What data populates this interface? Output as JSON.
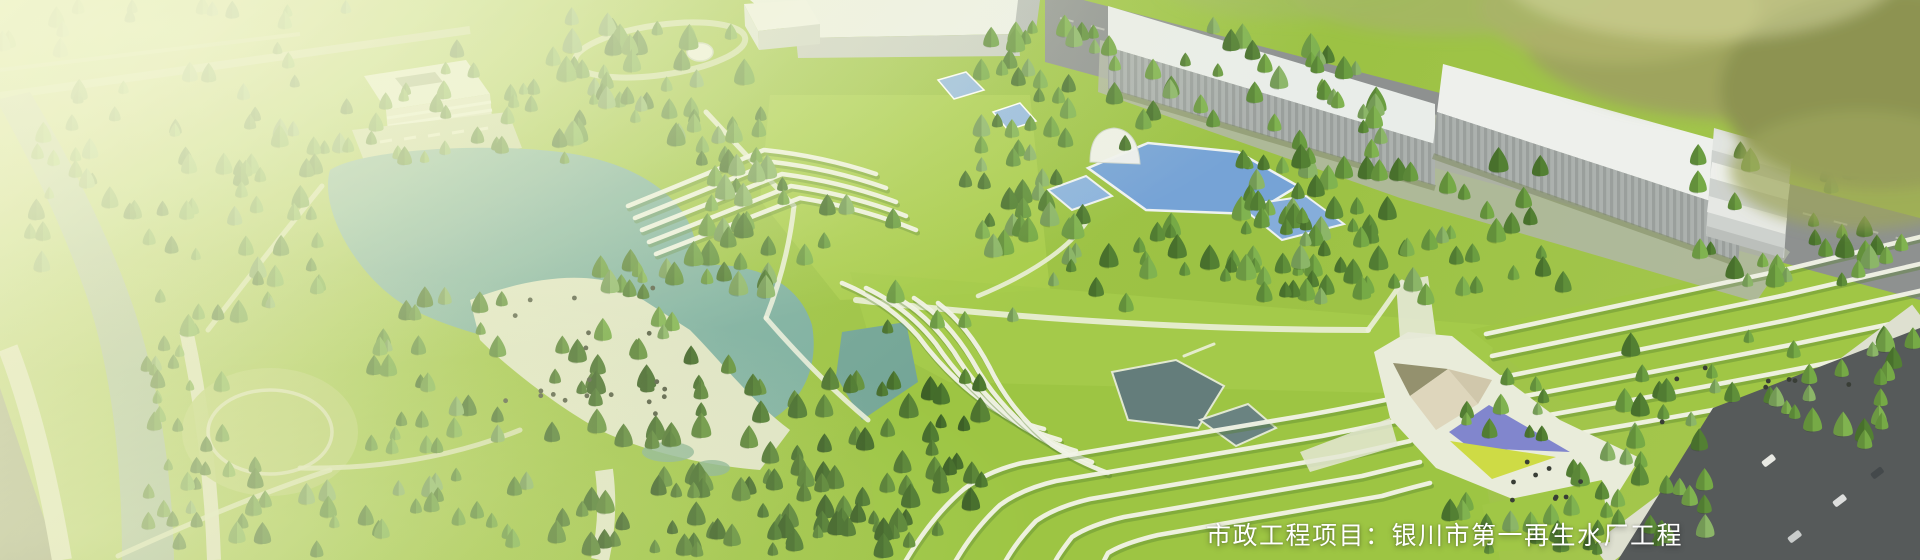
{
  "caption": {
    "text": "市政工程项目：银川市第一再生水厂工程"
  },
  "palette": {
    "grass_base": "#9ac23f",
    "grass_bright": "#a6cc47",
    "grass_slope": "#98c33c",
    "lake_water": "#78ada0",
    "pool_water": "#6f9fd8",
    "pond_dark": "#57707c",
    "beach": "#dfe4c6",
    "path_light": "#edf0e0",
    "road_dark": "#4d5154",
    "road_gray": "#888c8e",
    "sidewalk": "#dde0d2",
    "building_roof": "#eef1f0",
    "building_wall": "#a6acac",
    "canopy_beige": "#ded5bd",
    "triangle_purple": "#7b80cf",
    "triangle_yellow": "#cdda3e",
    "terrace_line": "#f2f4ea",
    "haze": "#f4f7d0",
    "caption_color": "#ffffff",
    "tree_colors": [
      "#4a7a2b",
      "#578a32",
      "#63993a",
      "#6fa63f",
      "#7ab04a",
      "#86b363"
    ],
    "tree_colors_dark": [
      "#3a6522",
      "#457428",
      "#507e2e",
      "#5b8c34"
    ]
  }
}
